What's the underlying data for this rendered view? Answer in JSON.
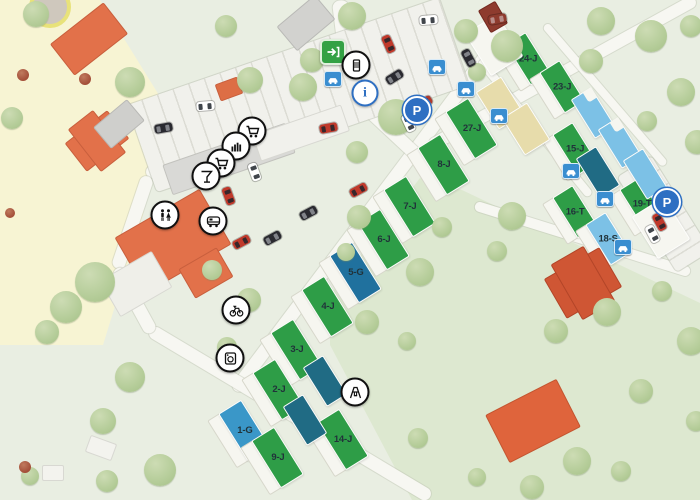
{
  "app": {
    "name": "campsite-map"
  },
  "colors": {
    "plot_green": "#2e9d47",
    "plot_teal": "#206b84",
    "plot_blue_mid": "#3a97c8",
    "plot_blue_dark": "#20719e",
    "plot_blue_light": "#7cc1e6",
    "plot_beige": "#e7dcab",
    "plot_empty": "#f6f6f0",
    "road": "#f7f7f2",
    "grass": "#e9eee2",
    "grass_dark": "#dce7cf",
    "sand_zone": "#f7f4d3",
    "building_orange": "#e2714a",
    "building_red": "#cf5634",
    "building_gray": "#d2d2cf",
    "icon_blue": "#2e6fc2",
    "icon_green": "#33a144",
    "icon_carpitch": "#3a8ed0"
  },
  "map": {
    "zones": [
      {
        "name": "sand-zone",
        "color": "#f7f4d3",
        "points": [
          [
            0,
            0
          ],
          [
            100,
            0
          ],
          [
            162,
            100
          ],
          [
            143,
            215
          ],
          [
            103,
            345
          ],
          [
            0,
            345
          ]
        ]
      },
      {
        "name": "field-zone",
        "color": "#dde8d0",
        "points": [
          [
            330,
            295
          ],
          [
            420,
            178
          ],
          [
            462,
            190
          ],
          [
            700,
            303
          ],
          [
            700,
            500
          ],
          [
            412,
            500
          ],
          [
            330,
            345
          ]
        ]
      }
    ],
    "roads": [
      {
        "name": "main-row-road",
        "x1": 235,
        "y1": 390,
        "x2": 505,
        "y2": 30,
        "w": 13
      },
      {
        "name": "lower-road",
        "x1": 150,
        "y1": 330,
        "x2": 430,
        "y2": 497,
        "w": 13
      },
      {
        "name": "left-road-1",
        "x1": 230,
        "y1": 103,
        "x2": 148,
        "y2": 176,
        "w": 13
      },
      {
        "name": "left-road-2",
        "x1": 148,
        "y1": 176,
        "x2": 117,
        "y2": 268,
        "w": 13
      },
      {
        "name": "left-road-3",
        "x1": 117,
        "y1": 268,
        "x2": 152,
        "y2": 332,
        "w": 13
      },
      {
        "name": "upper-cluster-road",
        "x1": 430,
        "y1": 146,
        "x2": 695,
        "y2": 0,
        "w": 12
      },
      {
        "name": "entrance-road",
        "x1": 340,
        "y1": 0,
        "x2": 352,
        "y2": 95,
        "w": 16
      },
      {
        "name": "junction-road",
        "x1": 352,
        "y1": 95,
        "x2": 430,
        "y2": 168,
        "w": 13
      },
      {
        "name": "cluster-path-1",
        "x1": 480,
        "y1": 60,
        "x2": 590,
        "y2": 195,
        "w": 8
      },
      {
        "name": "cluster-path-2",
        "x1": 545,
        "y1": 25,
        "x2": 665,
        "y2": 165,
        "w": 8
      },
      {
        "name": "east-road",
        "x1": 475,
        "y1": 205,
        "x2": 690,
        "y2": 272,
        "w": 10
      }
    ],
    "parkings": [
      {
        "name": "main-parking",
        "cx": 298,
        "cy": 95,
        "len": 330,
        "w": 92,
        "angle": -19
      },
      {
        "name": "east-parking",
        "cx": 664,
        "cy": 214,
        "len": 112,
        "w": 40,
        "angle": 58
      }
    ],
    "buildings": [
      {
        "name": "roundabout",
        "x": 46,
        "y": 3,
        "w": 34,
        "h": 34,
        "angle": 0,
        "color": "#cfc8bd",
        "border": "#e8e27a",
        "round": true
      },
      {
        "name": "house-nw-1",
        "x": 88,
        "y": 38,
        "w": 66,
        "h": 38,
        "angle": -38,
        "color": "#e2714a",
        "border": "#c85f3d"
      },
      {
        "name": "house-nw-2",
        "x": 96,
        "y": 140,
        "w": 52,
        "h": 34,
        "angle": -38,
        "color": "#e2714a",
        "border": "#c85f3d"
      },
      {
        "name": "house-nw-2b",
        "x": 96,
        "y": 140,
        "w": 30,
        "h": 52,
        "angle": -38,
        "color": "#e2714a",
        "border": "#c85f3d"
      },
      {
        "name": "gray-shed-top",
        "x": 305,
        "y": 22,
        "w": 48,
        "h": 30,
        "angle": -40,
        "color": "#d2d2cf",
        "border": "#b9b9b6"
      },
      {
        "name": "gray-shed-left",
        "x": 118,
        "y": 123,
        "w": 42,
        "h": 26,
        "angle": -40,
        "color": "#cfcfcc",
        "border": "#b9b9b6"
      },
      {
        "name": "orange-cube",
        "x": 228,
        "y": 88,
        "w": 22,
        "h": 16,
        "angle": -20,
        "color": "#dd6e45",
        "border": "#c85f3d"
      },
      {
        "name": "shop-slab",
        "x": 228,
        "y": 158,
        "w": 128,
        "h": 30,
        "angle": -19,
        "color": "#d9d9d6",
        "border": "#c2c2bd"
      },
      {
        "name": "shop-slab-ext",
        "x": 300,
        "y": 132,
        "w": 92,
        "h": 26,
        "angle": -19,
        "color": "#f1f1ec",
        "border": "#d8d8d2"
      },
      {
        "name": "reception",
        "x": 172,
        "y": 240,
        "w": 96,
        "h": 62,
        "angle": -30,
        "color": "#e2714a",
        "border": "#c85f3d"
      },
      {
        "name": "reception-wing",
        "x": 205,
        "y": 272,
        "w": 42,
        "h": 32,
        "angle": -30,
        "color": "#e2714a",
        "border": "#c85f3d"
      },
      {
        "name": "terrace",
        "x": 135,
        "y": 283,
        "w": 58,
        "h": 40,
        "angle": -30,
        "color": "#efefe9",
        "border": "#d8d8d2"
      },
      {
        "name": "red-house-east",
        "x": 582,
        "y": 282,
        "w": 62,
        "h": 44,
        "angle": -30,
        "color": "#cf5634",
        "border": "#b34528"
      },
      {
        "name": "red-house-east-b",
        "x": 582,
        "y": 282,
        "w": 36,
        "h": 62,
        "angle": -30,
        "color": "#cf5634",
        "border": "#b34528"
      },
      {
        "name": "orange-hall-south",
        "x": 532,
        "y": 420,
        "w": 78,
        "h": 52,
        "angle": -27,
        "color": "#df643c",
        "border": "#c35530"
      },
      {
        "name": "red-hut-top",
        "x": 492,
        "y": 16,
        "w": 18,
        "h": 24,
        "angle": -30,
        "color": "#8e3b2e",
        "border": "#73291f"
      },
      {
        "name": "white-shed-sw1",
        "x": 100,
        "y": 447,
        "w": 26,
        "h": 16,
        "angle": 20,
        "color": "#f3f3ee",
        "border": "#d8d8d2"
      },
      {
        "name": "white-shed-sw2",
        "x": 52,
        "y": 472,
        "w": 20,
        "h": 14,
        "angle": 0,
        "color": "#f3f3ee",
        "border": "#d8d8d2"
      }
    ],
    "plots": [
      {
        "label": "27-J",
        "x": 466,
        "y": 132,
        "kind": "main",
        "color": "green"
      },
      {
        "label": "8-J",
        "x": 438,
        "y": 168,
        "kind": "main",
        "color": "green"
      },
      {
        "label": "7-J",
        "x": 404,
        "y": 210,
        "kind": "main",
        "color": "green"
      },
      {
        "label": "6-J",
        "x": 378,
        "y": 243,
        "kind": "main",
        "color": "green"
      },
      {
        "label": "5-G",
        "x": 350,
        "y": 276,
        "kind": "main",
        "color": "blue_dark"
      },
      {
        "label": "4-J",
        "x": 322,
        "y": 310,
        "kind": "main",
        "color": "green"
      },
      {
        "label": "3-J",
        "x": 291,
        "y": 353,
        "kind": "main",
        "color": "green"
      },
      {
        "label": "2-J",
        "x": 273,
        "y": 393,
        "kind": "main",
        "color": "green"
      },
      {
        "label": "1-G",
        "x": 239,
        "y": 434,
        "kind": "main",
        "color": "blue_mid"
      },
      {
        "label": "9-J",
        "x": 272,
        "y": 461,
        "kind": "main",
        "color": "green"
      },
      {
        "label": "14-J",
        "x": 337,
        "y": 443,
        "kind": "main",
        "color": "green"
      },
      {
        "label": "",
        "x": 325,
        "y": 381,
        "kind": "strip",
        "color": "teal"
      },
      {
        "label": "",
        "x": 305,
        "y": 420,
        "kind": "strip",
        "color": "teal"
      },
      {
        "label": "24-J",
        "x": 523,
        "y": 62,
        "kind": "cluster",
        "color": "green"
      },
      {
        "label": "23-J",
        "x": 557,
        "y": 90,
        "kind": "cluster",
        "color": "green"
      },
      {
        "label": "15-J",
        "x": 570,
        "y": 152,
        "kind": "cluster",
        "color": "green"
      },
      {
        "label": "16-T",
        "x": 570,
        "y": 215,
        "kind": "cluster",
        "color": "green"
      },
      {
        "label": "19-T",
        "x": 637,
        "y": 207,
        "kind": "cluster",
        "color": "green"
      },
      {
        "label": "18-S",
        "x": 603,
        "y": 242,
        "kind": "cluster",
        "color": "blue_light"
      },
      {
        "label": "",
        "x": 500,
        "y": 103,
        "kind": "beige",
        "color": "beige"
      },
      {
        "label": "",
        "x": 526,
        "y": 129,
        "kind": "beige",
        "color": "beige"
      },
      {
        "label": "",
        "x": 593,
        "y": 113,
        "kind": "strip",
        "color": "blue_light",
        "notch": true
      },
      {
        "label": "",
        "x": 620,
        "y": 143,
        "kind": "strip",
        "color": "blue_light",
        "notch": true
      },
      {
        "label": "",
        "x": 598,
        "y": 172,
        "kind": "strip",
        "color": "teal"
      },
      {
        "label": "",
        "x": 645,
        "y": 174,
        "kind": "strip",
        "color": "blue_light"
      },
      {
        "label": "",
        "x": 494,
        "y": 45,
        "kind": "empty",
        "color": "empty"
      },
      {
        "label": "",
        "x": 661,
        "y": 228,
        "kind": "empty",
        "color": "empty"
      }
    ],
    "trees": [
      [
        36,
        14,
        13
      ],
      [
        130,
        82,
        15
      ],
      [
        12,
        118,
        11
      ],
      [
        95,
        282,
        20
      ],
      [
        66,
        307,
        16
      ],
      [
        47,
        332,
        12
      ],
      [
        130,
        377,
        15
      ],
      [
        103,
        421,
        13
      ],
      [
        160,
        470,
        16
      ],
      [
        107,
        481,
        11
      ],
      [
        30,
        476,
        9
      ],
      [
        226,
        26,
        11
      ],
      [
        250,
        80,
        13
      ],
      [
        303,
        87,
        14
      ],
      [
        212,
        270,
        10
      ],
      [
        249,
        300,
        12
      ],
      [
        227,
        347,
        10
      ],
      [
        352,
        16,
        14
      ],
      [
        312,
        60,
        12
      ],
      [
        396,
        117,
        18
      ],
      [
        357,
        152,
        11
      ],
      [
        359,
        217,
        12
      ],
      [
        346,
        252,
        9
      ],
      [
        420,
        272,
        14
      ],
      [
        442,
        227,
        10
      ],
      [
        367,
        322,
        12
      ],
      [
        407,
        341,
        9
      ],
      [
        466,
        31,
        12
      ],
      [
        507,
        46,
        16
      ],
      [
        601,
        21,
        14
      ],
      [
        651,
        36,
        16
      ],
      [
        691,
        26,
        11
      ],
      [
        591,
        61,
        12
      ],
      [
        681,
        92,
        14
      ],
      [
        647,
        121,
        10
      ],
      [
        697,
        142,
        12
      ],
      [
        477,
        72,
        9
      ],
      [
        512,
        216,
        14
      ],
      [
        497,
        251,
        10
      ],
      [
        556,
        331,
        12
      ],
      [
        607,
        312,
        14
      ],
      [
        662,
        291,
        10
      ],
      [
        691,
        341,
        14
      ],
      [
        641,
        391,
        12
      ],
      [
        696,
        421,
        10
      ],
      [
        577,
        461,
        14
      ],
      [
        621,
        471,
        10
      ],
      [
        532,
        487,
        12
      ],
      [
        477,
        477,
        9
      ],
      [
        418,
        438,
        10
      ]
    ],
    "bushes": [
      [
        23,
        75,
        6
      ],
      [
        85,
        79,
        6
      ],
      [
        25,
        467,
        6
      ],
      [
        10,
        213,
        5
      ]
    ],
    "cars": [
      {
        "x": 205,
        "y": 106,
        "a": 85,
        "c": "#ffffff"
      },
      {
        "x": 163,
        "y": 128,
        "a": 80,
        "c": "#2a2a30"
      },
      {
        "x": 228,
        "y": 196,
        "a": -20,
        "c": "#c0392b"
      },
      {
        "x": 254,
        "y": 172,
        "a": -20,
        "c": "#ffffff"
      },
      {
        "x": 241,
        "y": 242,
        "a": 62,
        "c": "#c0392b"
      },
      {
        "x": 272,
        "y": 238,
        "a": 62,
        "c": "#2a2a30"
      },
      {
        "x": 308,
        "y": 213,
        "a": 62,
        "c": "#2a2a30"
      },
      {
        "x": 358,
        "y": 190,
        "a": 62,
        "c": "#c0392b"
      },
      {
        "x": 328,
        "y": 128,
        "a": 80,
        "c": "#c0392b"
      },
      {
        "x": 388,
        "y": 44,
        "a": -24,
        "c": "#c0392b"
      },
      {
        "x": 394,
        "y": 77,
        "a": 58,
        "c": "#2a2a30"
      },
      {
        "x": 428,
        "y": 20,
        "a": 85,
        "c": "#ffffff"
      },
      {
        "x": 497,
        "y": 19,
        "a": 80,
        "c": "#8e3b2e"
      },
      {
        "x": 468,
        "y": 58,
        "a": -28,
        "c": "#2a2a30"
      },
      {
        "x": 423,
        "y": 103,
        "a": 60,
        "c": "#b03a2e"
      },
      {
        "x": 408,
        "y": 123,
        "a": -25,
        "c": "#ffffff"
      },
      {
        "x": 659,
        "y": 222,
        "a": -28,
        "c": "#c0392b"
      },
      {
        "x": 652,
        "y": 234,
        "a": -28,
        "c": "#ffffff"
      }
    ],
    "icons": [
      {
        "type": "entrance",
        "x": 333,
        "y": 52
      },
      {
        "type": "barrier-gate",
        "x": 356,
        "y": 65
      },
      {
        "type": "info",
        "x": 365,
        "y": 93,
        "letter": "i"
      },
      {
        "type": "parking",
        "x": 417,
        "y": 110,
        "letter": "P"
      },
      {
        "type": "parking",
        "x": 667,
        "y": 202,
        "letter": "P"
      },
      {
        "type": "shopping-cart",
        "x": 252,
        "y": 131
      },
      {
        "type": "kiosk",
        "x": 236,
        "y": 146
      },
      {
        "type": "shopping-cart",
        "x": 221,
        "y": 163
      },
      {
        "type": "bar",
        "x": 206,
        "y": 176
      },
      {
        "type": "restrooms",
        "x": 165,
        "y": 215
      },
      {
        "type": "camper-service",
        "x": 213,
        "y": 221
      },
      {
        "type": "bicycle",
        "x": 236,
        "y": 310
      },
      {
        "type": "laundry",
        "x": 230,
        "y": 358
      },
      {
        "type": "playground",
        "x": 355,
        "y": 392
      },
      {
        "type": "car-pitch",
        "x": 333,
        "y": 79
      },
      {
        "type": "car-pitch",
        "x": 437,
        "y": 67
      },
      {
        "type": "car-pitch",
        "x": 466,
        "y": 89
      },
      {
        "type": "car-pitch",
        "x": 499,
        "y": 116
      },
      {
        "type": "car-pitch",
        "x": 571,
        "y": 171
      },
      {
        "type": "car-pitch",
        "x": 605,
        "y": 199
      },
      {
        "type": "car-pitch",
        "x": 623,
        "y": 247
      }
    ]
  }
}
